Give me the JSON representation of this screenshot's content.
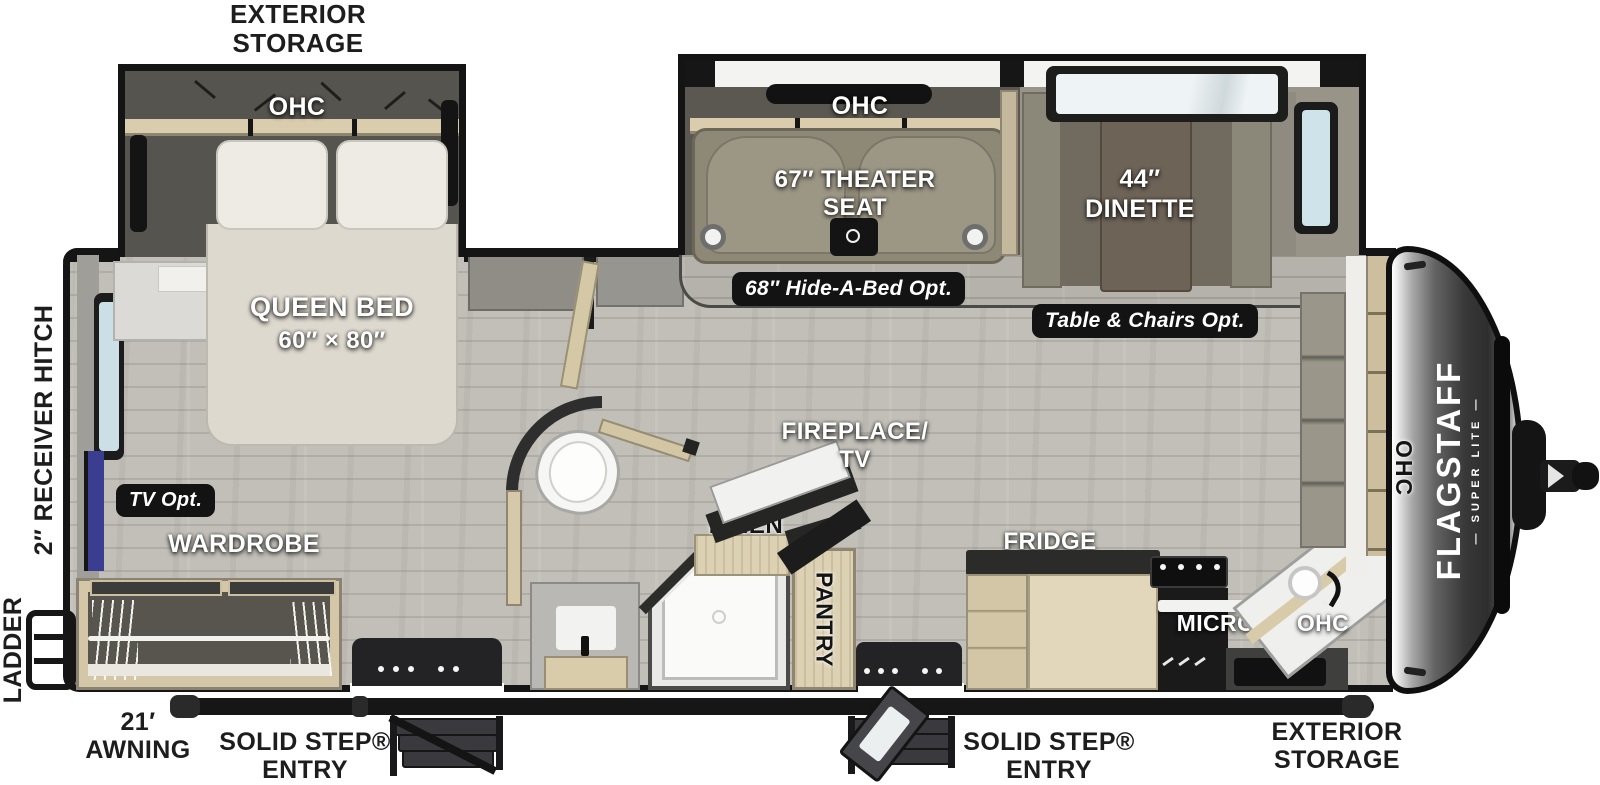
{
  "exterior": {
    "storage_rear": [
      "EXTERIOR",
      "STORAGE"
    ],
    "receiver_hitch": "2″ RECEIVER HITCH",
    "ladder": "LADDER",
    "awning": [
      "21′",
      "AWNING"
    ],
    "entry1": [
      "SOLID STEP®",
      "ENTRY"
    ],
    "entry2": [
      "SOLID STEP®",
      "ENTRY"
    ],
    "storage_front": [
      "EXTERIOR",
      "STORAGE"
    ]
  },
  "bedroom": {
    "ohc": "OHC",
    "queen_bed": [
      "QUEEN BED",
      "60″ × 80″"
    ],
    "tv_opt": "TV Opt.",
    "wardrobe": "WARDROBE"
  },
  "living": {
    "ohc": "OHC",
    "theater": [
      "67″ THEATER",
      "SEAT"
    ],
    "hide_a_bed": "68″ Hide-A-Bed Opt.",
    "dinette": [
      "44″",
      "DINETTE"
    ],
    "table_chairs": "Table & Chairs Opt.",
    "fireplace": [
      "FIREPLACE/",
      "TV"
    ]
  },
  "bath": {
    "linen": "LINEN",
    "pantry": "PANTRY"
  },
  "kitchen": {
    "fridge": "FRIDGE",
    "micro": "MICRO",
    "ohc": "OHC",
    "ohc_front": "OHC"
  },
  "brand": {
    "name": "FLAGSTAFF",
    "sub": "— SUPER LITE —"
  },
  "colors": {
    "wall": "#151515",
    "wood_cab": "#d9cdae",
    "floor": "#c1bfb7",
    "glass": "#cfe3ea",
    "tv_blue": "#3b3e90",
    "badge_bg": "#131313",
    "cap_dark": "#343434",
    "sofa": "#8e8876"
  }
}
